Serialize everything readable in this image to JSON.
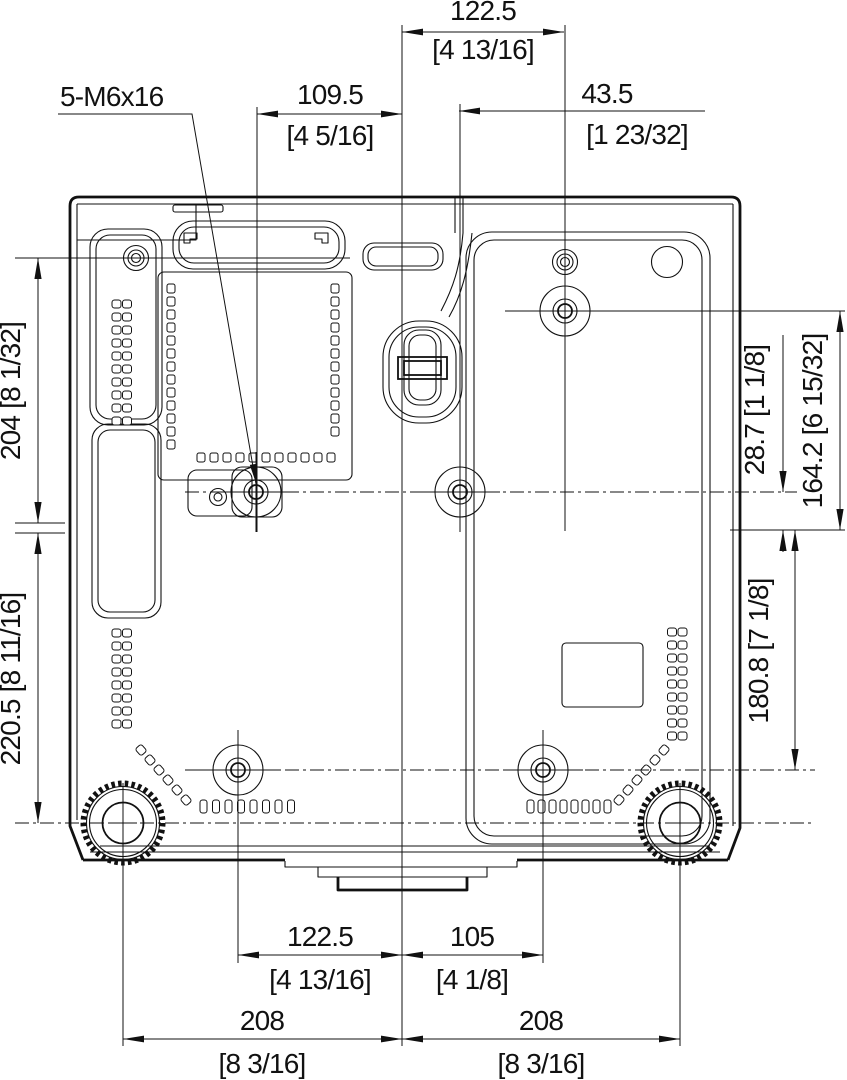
{
  "colors": {
    "line": "#111111",
    "background": "#ffffff"
  },
  "screw_spec_label": "5-M6x16",
  "dims": {
    "top_center": {
      "mm": "122.5",
      "inch": "[4 13/16]"
    },
    "top_left": {
      "mm": "109.5",
      "inch": "[4 5/16]"
    },
    "top_right": {
      "mm": "43.5",
      "inch": "[1 23/32]"
    },
    "left_upper": {
      "combined": "204 [8 1/32]"
    },
    "left_lower": {
      "combined": "220.5 [8 11/16]"
    },
    "right_offset": {
      "combined": "28.7 [1 1/8]"
    },
    "right_upper": {
      "combined": "164.2 [6 15/32]"
    },
    "right_lower": {
      "combined": "180.8 [7 1/8]"
    },
    "bottom_left_hole": {
      "mm": "122.5",
      "inch": "[4 13/16]"
    },
    "bottom_right_hole": {
      "mm": "105",
      "inch": "[4 1/8]"
    },
    "bottom_left_foot": {
      "mm": "208",
      "inch": "[8 3/16]"
    },
    "bottom_right_foot": {
      "mm": "208",
      "inch": "[8 3/16]"
    }
  }
}
